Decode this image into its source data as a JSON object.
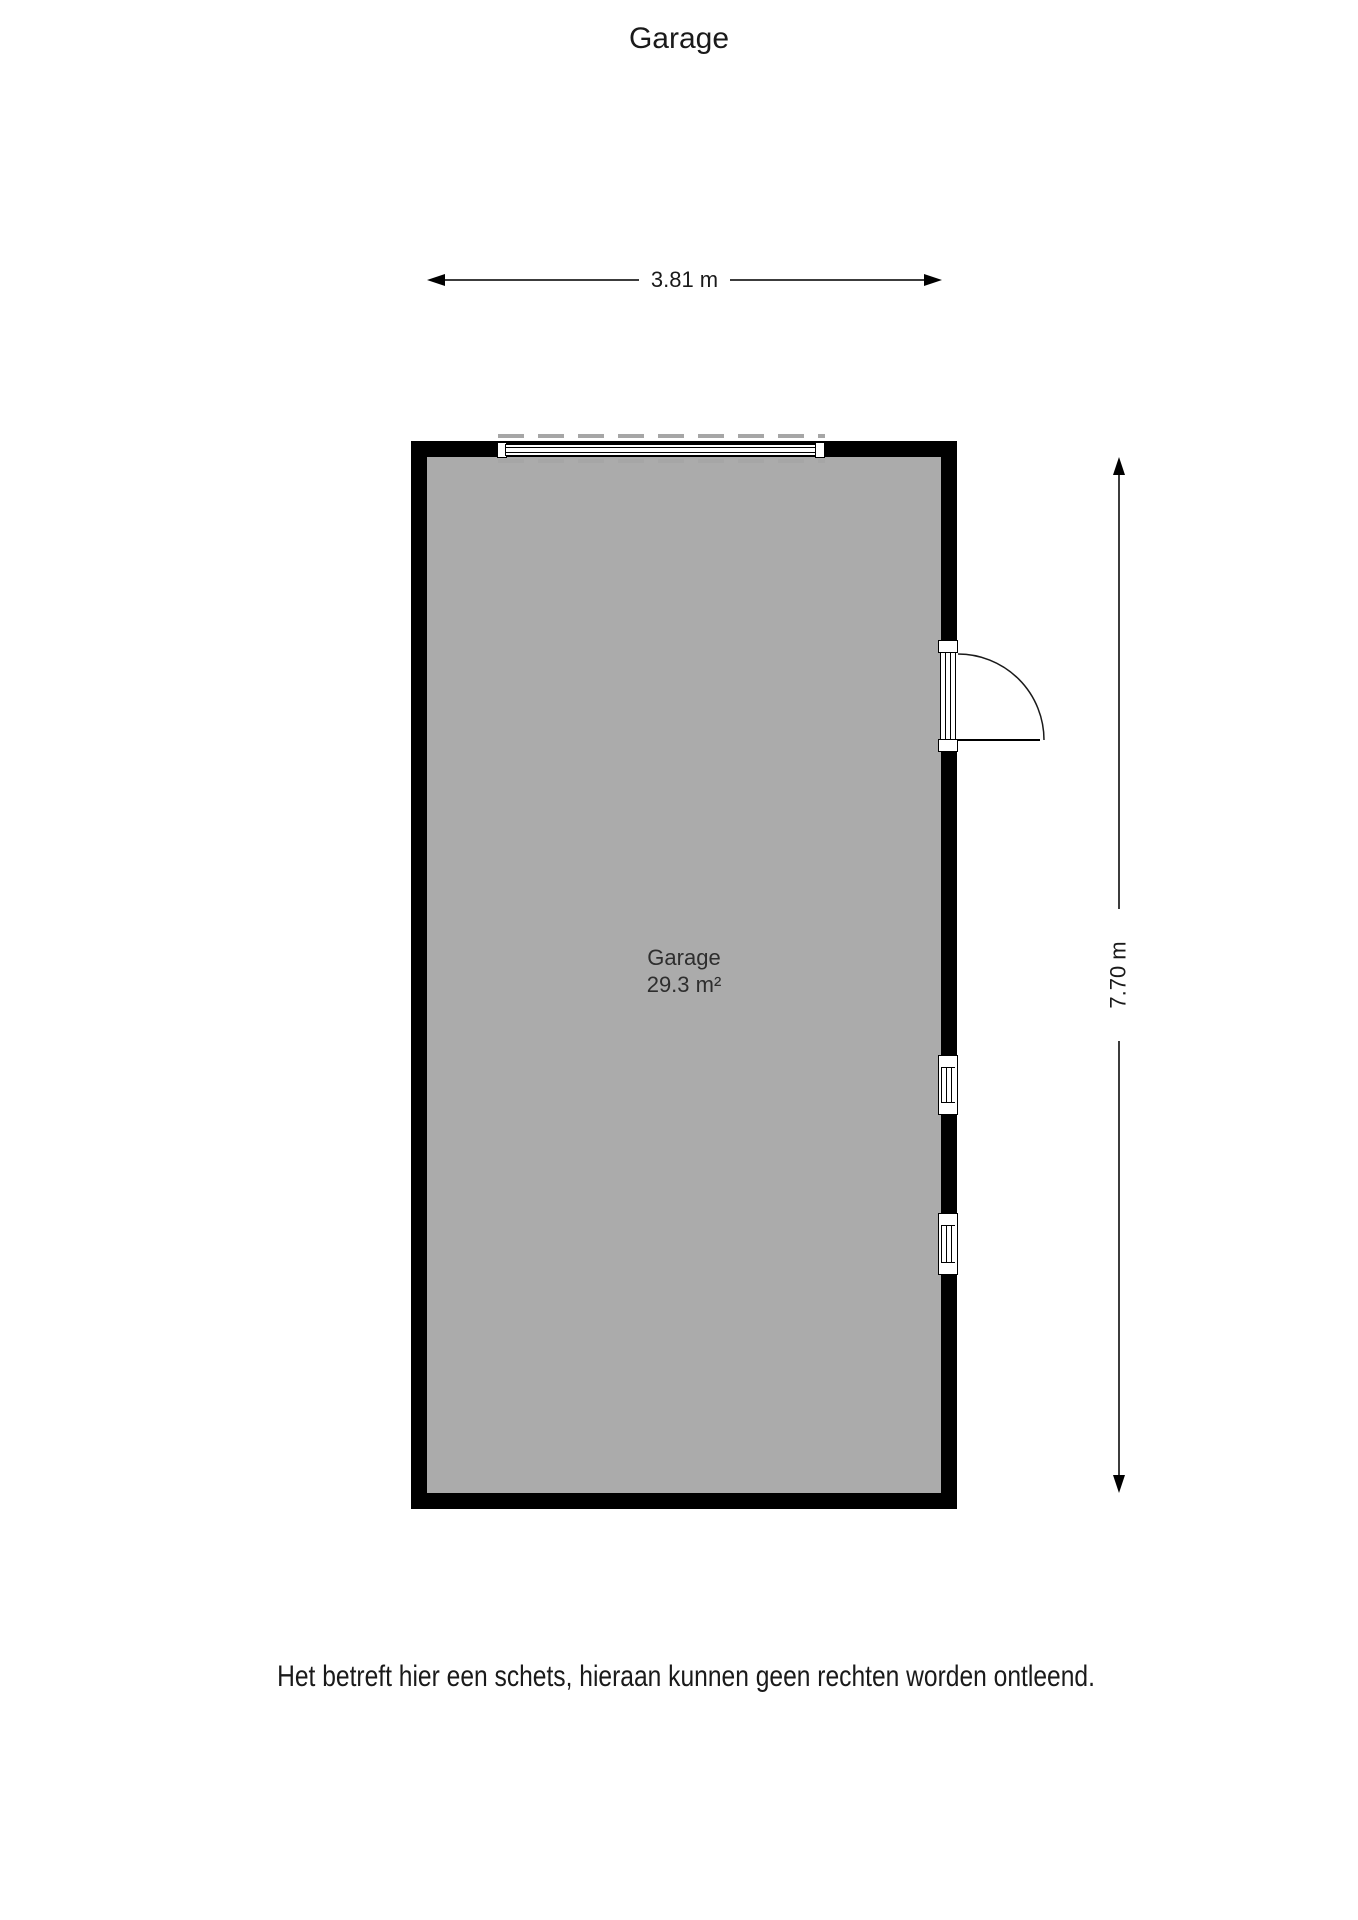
{
  "page": {
    "title": "Garage",
    "disclaimer": "Het betreft hier een schets, hieraan kunnen geen rechten worden ontleend."
  },
  "floorplan": {
    "room": {
      "name": "Garage",
      "area": "29.3 m²"
    },
    "dimensions": {
      "width": "3.81 m",
      "height": "7.70 m"
    },
    "features": {
      "garage_door": "top wall",
      "swing_door": "right wall",
      "windows": 2
    },
    "colors": {
      "wall": "#000000",
      "floor": "#ABABAB",
      "dash": "#A6A6A6",
      "dimension_line": "#3C3C3C",
      "text": "#1A1A1A"
    }
  }
}
